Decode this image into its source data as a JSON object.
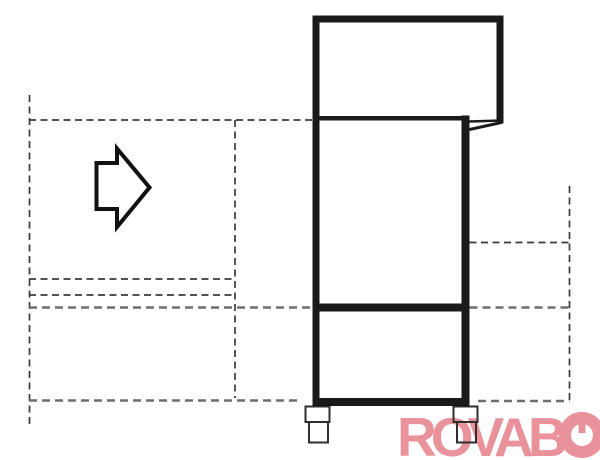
{
  "page": {
    "background": "#ffffff",
    "width_px": 600,
    "height_px": 460
  },
  "drawing": {
    "kind": "technical outline drawing",
    "subject": "side view of a hood-type machine standing on two feet, with dashed clearance and reference outlines and a hollow right-pointing direction arrow",
    "ink_color": "#1a1a1a",
    "dash_color_primary": "#3a3a3a",
    "dash_color_secondary": "#6e6e6e"
  },
  "arrow": {
    "name": "arrow-right-icon",
    "direction": "right"
  },
  "logo": {
    "text": "ROVABO",
    "text_prefix": "ROVAB",
    "final_glyph": "O-with-power-symbol",
    "color": "#ea929b"
  }
}
